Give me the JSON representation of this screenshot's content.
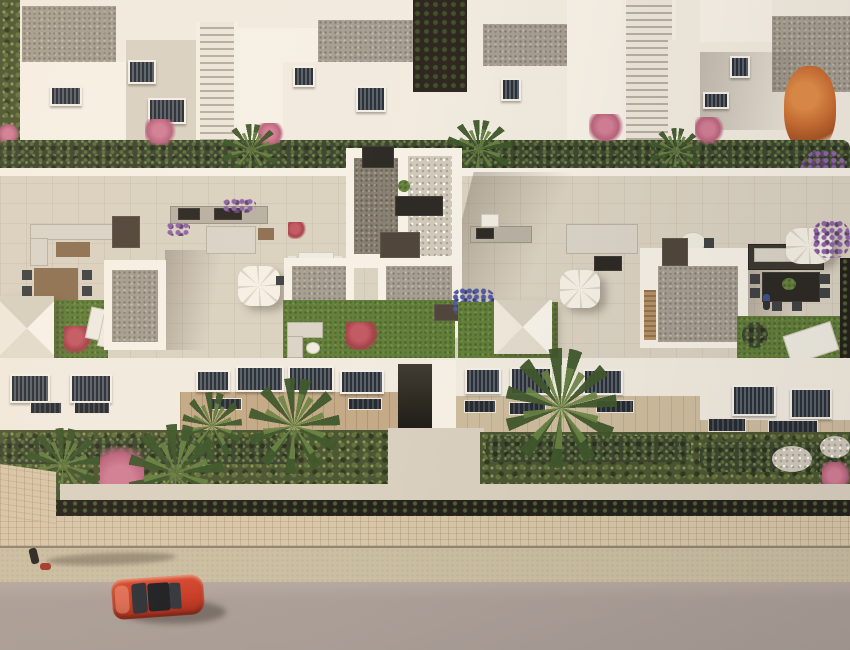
{
  "scene": {
    "title": "Aerial 3D render of a white townhouse complex with roof terraces",
    "setting": "late-afternoon sunlight from the left, long soft shadows to the right",
    "palette": {
      "wall_white": "#f1ebe0",
      "wall_shade": "#d8d1c3",
      "gravel_roof": "#a39c8f",
      "terrace_tile": "#d9d1c1",
      "grass": "#5d7b36",
      "hedge": "#36402a",
      "wood_furniture": "#8a6e4f",
      "deck": "#c2a885",
      "stone_wall": "#d7c5a7",
      "sidewalk": "#c9bda1",
      "road": "#a89c96",
      "car_red": "#c63420",
      "tree_orange": "#c96a2e",
      "flower_pink": "#b75f7b",
      "flower_purple": "#8d5fa8",
      "umbrella_white": "#f5f1e7"
    },
    "objects": [
      "upper row of white townhouses with gravel flat roofs and two outdoor staircases",
      "dark planted alley between upper buildings",
      "hedge and palm strip between building rows",
      "four roof-terrace units with outdoor kitchens, sofas and dining sets",
      "four white sun parasols (two square, two octagonal)",
      "artificial grass roof patches with red flower bushes and sun loungers",
      "central stairwell towers topped with gravel",
      "lower facades with dark louvered windows and wooden decks",
      "tropical front garden with palms, bougainvillea and white pebbles",
      "stone boundary wall over a dark planting strip",
      "sidewalk with a pedestrian walking a dog, long shadow to the right",
      "gray road with a red coupe car seen from above",
      "one resident standing on the right terrace, one seated on the center terrace"
    ]
  }
}
